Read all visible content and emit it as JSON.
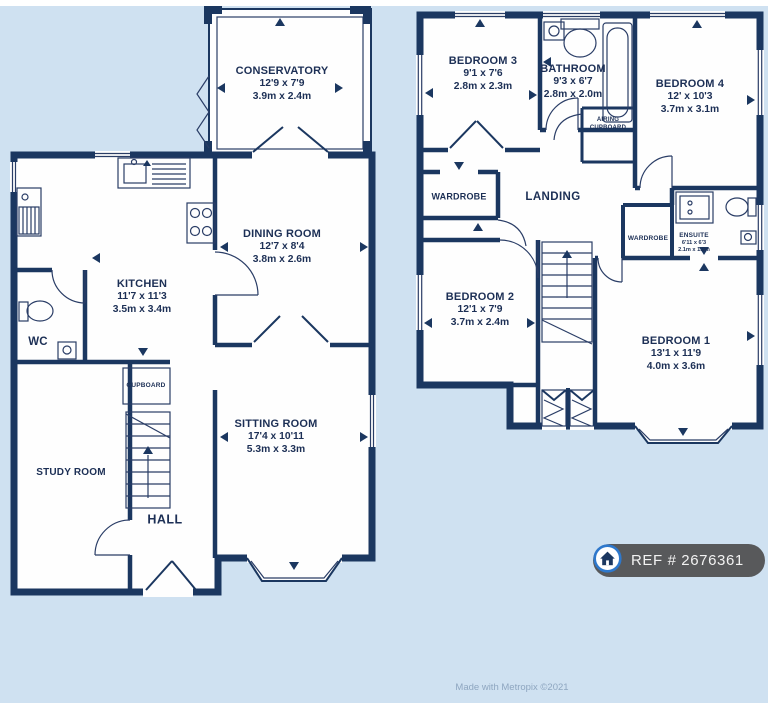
{
  "colors": {
    "background": "#cfe1f1",
    "wall": "#1b3760",
    "room_fill": "#fefefe",
    "label_text": "#1c2f55",
    "badge_bg": "#58595b",
    "badge_text": "#f2f2f2",
    "icon_ring_blue": "#2e78cc",
    "credit_text": "#8ea6c0"
  },
  "ground_floor": {
    "conservatory": {
      "name": "CONSERVATORY",
      "dims_ft": "12'9 x 7'9",
      "dims_m": "3.9m x 2.4m"
    },
    "dining_room": {
      "name": "DINING ROOM",
      "dims_ft": "12'7 x 8'4",
      "dims_m": "3.8m x 2.6m"
    },
    "kitchen": {
      "name": "KITCHEN",
      "dims_ft": "11'7 x 11'3",
      "dims_m": "3.5m x 3.4m"
    },
    "wc": {
      "name": "WC"
    },
    "cupboard": {
      "name": "CUPBOARD"
    },
    "study_room": {
      "name": "STUDY ROOM"
    },
    "hall": {
      "name": "HALL"
    },
    "sitting_room": {
      "name": "SITTING ROOM",
      "dims_ft": "17'4 x 10'11",
      "dims_m": "5.3m x 3.3m"
    }
  },
  "first_floor": {
    "bedroom3": {
      "name": "BEDROOM 3",
      "dims_ft": "9'1 x 7'6",
      "dims_m": "2.8m x 2.3m"
    },
    "bathroom": {
      "name": "BATHROOM",
      "dims_ft": "9'3 x 6'7",
      "dims_m": "2.8m x 2.0m"
    },
    "bedroom4": {
      "name": "BEDROOM 4",
      "dims_ft": "12' x 10'3",
      "dims_m": "3.7m x 3.1m"
    },
    "airing_cupboard": {
      "name": "AIRING CUPBOARD"
    },
    "wardrobe_left": {
      "name": "WARDROBE"
    },
    "landing": {
      "name": "LANDING"
    },
    "bedroom2": {
      "name": "BEDROOM 2",
      "dims_ft": "12'1 x 7'9",
      "dims_m": "3.7m x 2.4m"
    },
    "wardrobe_right": {
      "name": "WARDROBE"
    },
    "ensuite": {
      "name": "ENSUITE",
      "dims_ft": "6'11 x 6'3",
      "dims_m": "2.1m x 1.9m"
    },
    "bedroom1": {
      "name": "BEDROOM 1",
      "dims_ft": "13'1 x 11'9",
      "dims_m": "4.0m x 3.6m"
    }
  },
  "badge": {
    "ref": "REF # 2676361"
  },
  "footer": {
    "credit": "Made with Metropix ©2021"
  }
}
